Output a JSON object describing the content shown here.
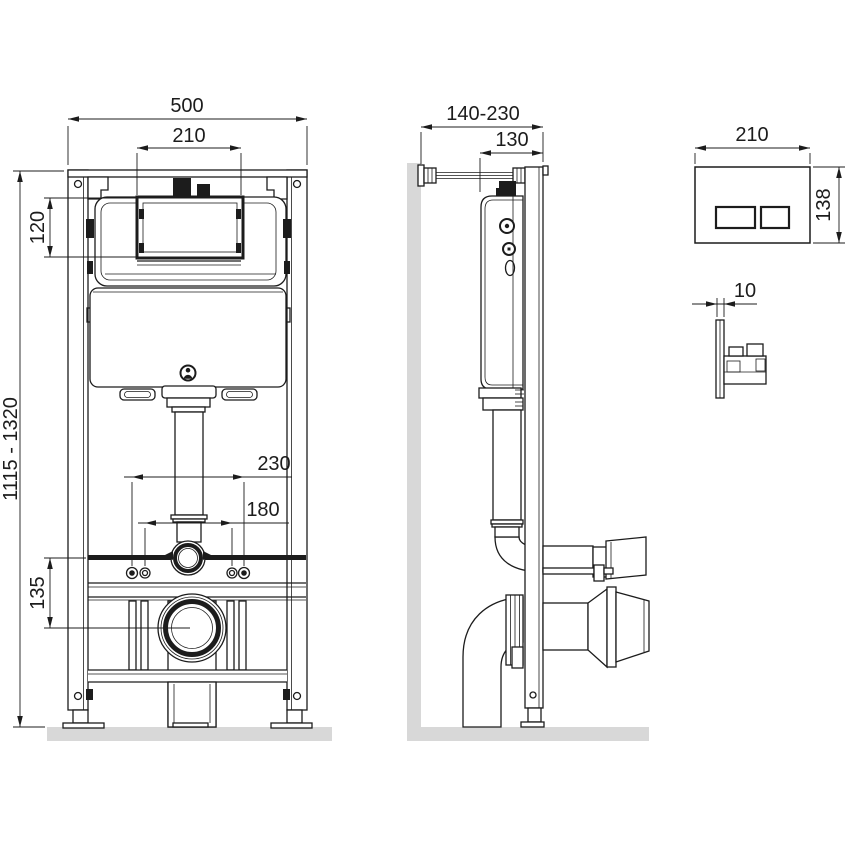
{
  "drawing": {
    "front_view": {
      "frame_width": "500",
      "opening_width": "210",
      "opening_height": "120",
      "height_range": "1115 - 1320",
      "fixing_spacing_outer": "230",
      "fixing_spacing_inner": "180",
      "outlet_height": "135"
    },
    "side_view": {
      "wall_distance_range": "140-230",
      "frame_depth": "130"
    },
    "flush_plate": {
      "width": "210",
      "height": "138",
      "thickness": "10"
    },
    "colors": {
      "line": "#1c1c1c",
      "wall_floor_surface": "#d8d8d8",
      "background": "#ffffff"
    },
    "icons": {
      "logo": "person-logo-icon"
    }
  }
}
